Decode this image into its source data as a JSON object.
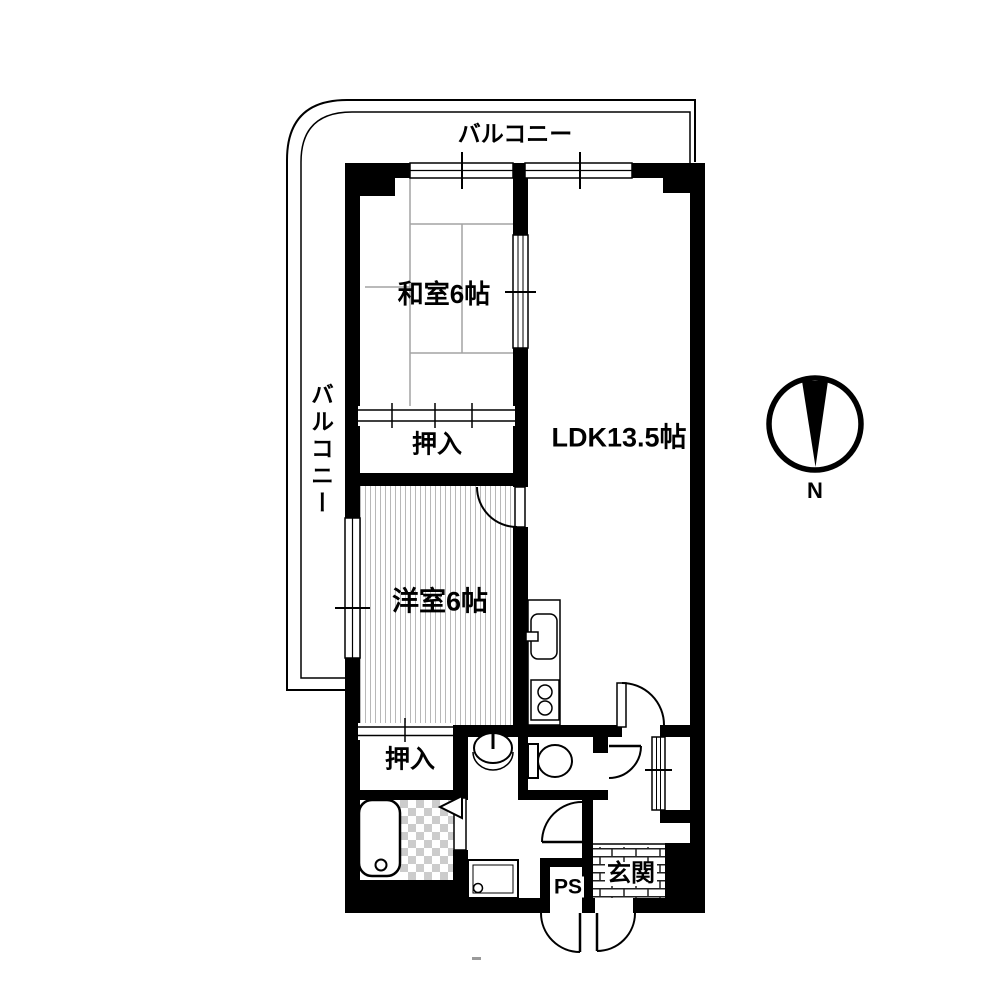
{
  "labels": {
    "balcony_top": "バルコニー",
    "balcony_left": "バルコニー",
    "japanese_room": "和室6帖",
    "ldk": "LDK13.5帖",
    "closet_upper": "押入",
    "western_room": "洋室6帖",
    "closet_lower": "押入",
    "pipe_space": "PS",
    "entrance": "玄関",
    "compass": "N"
  },
  "fixtures": [
    "bathtub",
    "shower-folding-door",
    "washing-machine-pan",
    "washbasin",
    "toilet",
    "kitchen-sink",
    "stove",
    "tatami-grid",
    "wood-floor-hatch",
    "entrance-tile",
    "north-compass"
  ],
  "colors": {
    "wall": "#000000",
    "background": "#ffffff",
    "tatami_line": "#a3a3a3",
    "floor_hatch": "#b8b8b8",
    "checker": "#cccccc",
    "brick_line": "#222222"
  }
}
